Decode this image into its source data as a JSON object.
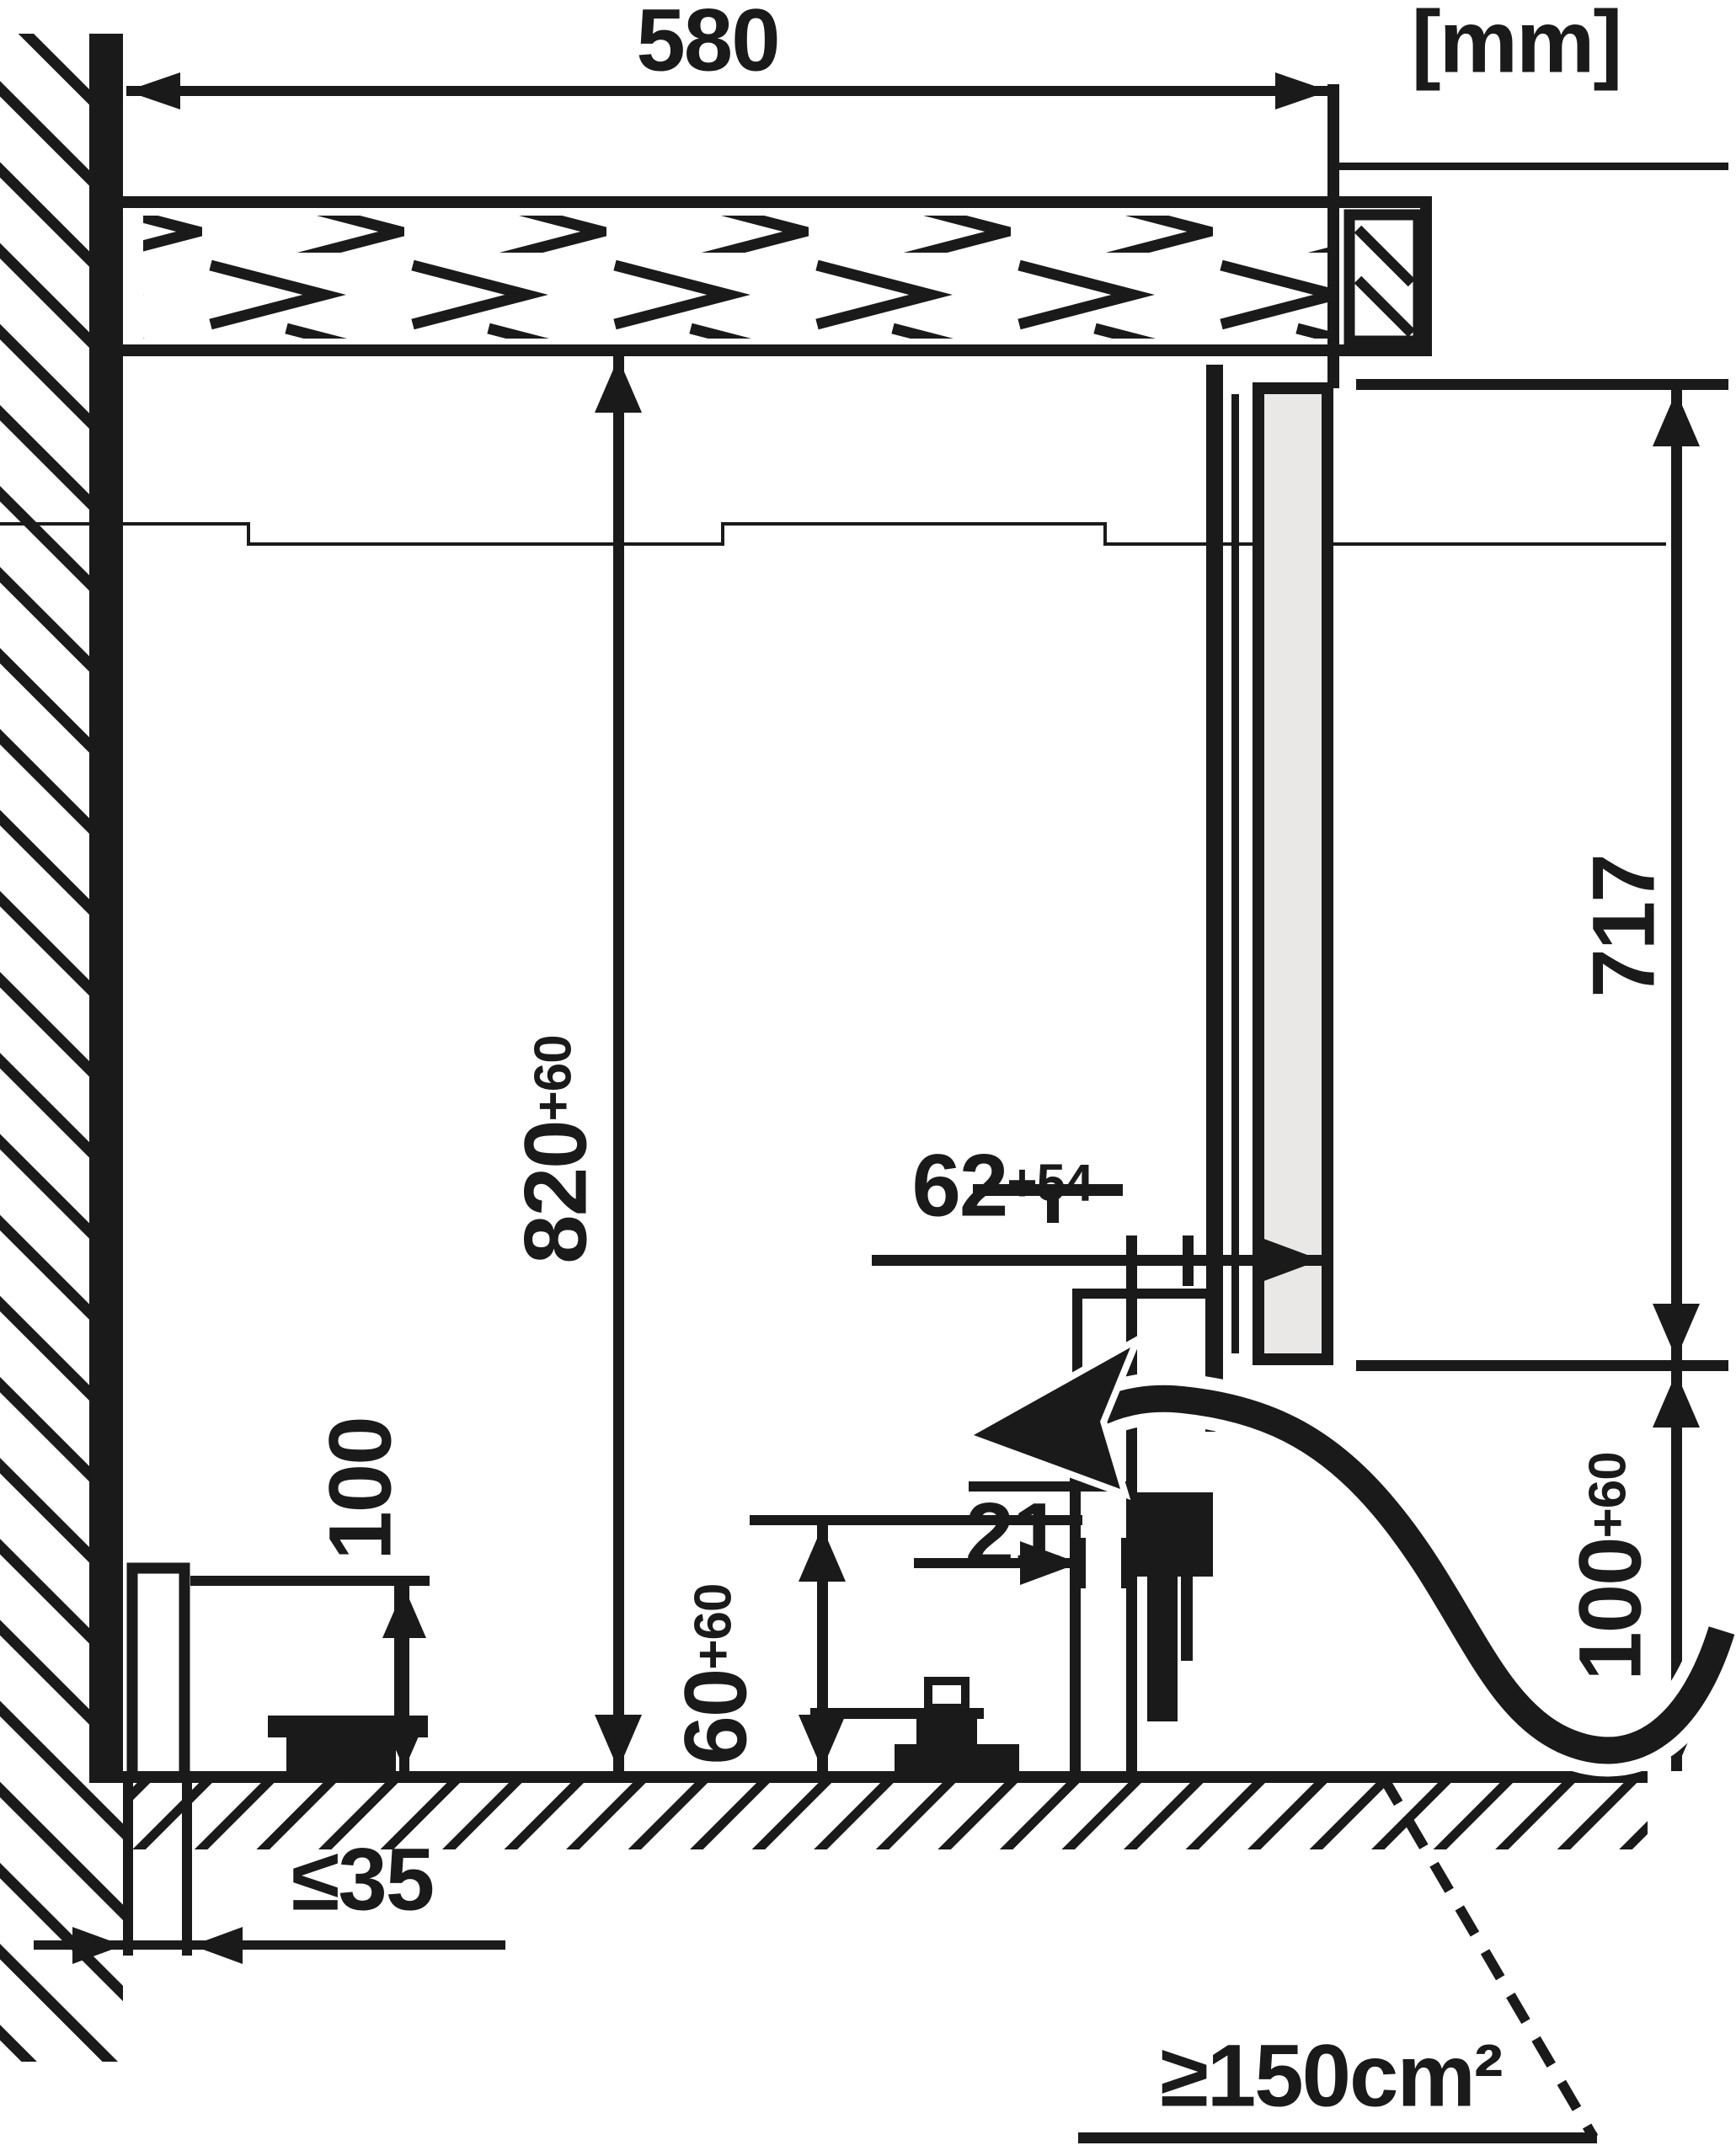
{
  "title": "built-under appliance installation side-section diagram",
  "unit_label": "[mm]",
  "dimensions": {
    "niche_depth": {
      "label": "580"
    },
    "door_height": {
      "label": "717"
    },
    "niche_height": {
      "main": "820",
      "sup": "+60"
    },
    "door_offset": {
      "main": "62",
      "sup": "+54"
    },
    "front_gap": {
      "label": "21"
    },
    "vent_height": {
      "main": "60",
      "sup": "+60"
    },
    "socket_height": {
      "label": "100"
    },
    "plinth_height": {
      "main": "100",
      "sup": "+60"
    },
    "wall_clearance": {
      "label": "≤35"
    },
    "vent_area": {
      "label": "≥150cm²"
    }
  },
  "colors": {
    "line": "#1a1a1a",
    "door_fill": "#e9e8e6",
    "background": "#ffffff"
  }
}
